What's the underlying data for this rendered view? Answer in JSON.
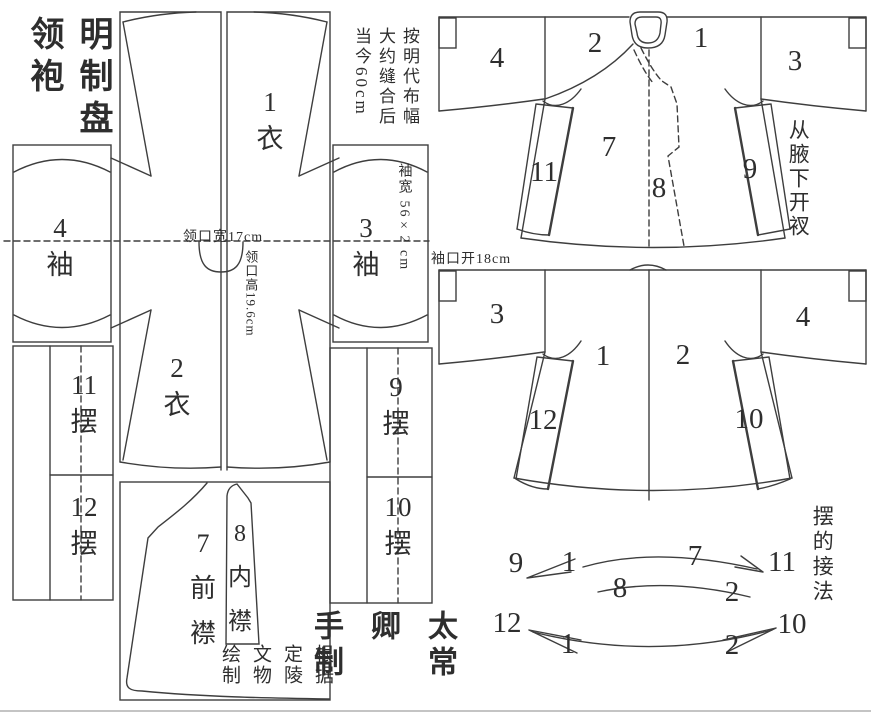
{
  "header": {
    "title": "明制盘\n领袍"
  },
  "notes": {
    "fabric": "按明代布幅\n大约缝合后\n当今60cm",
    "slit": "从腋下开衩",
    "assembly_title": "摆的接法",
    "credit": "根据\n定陵\n文物\n绘制",
    "signature": "太常卿\n手制"
  },
  "measurements": {
    "neck_width": "领口宽17cm",
    "neck_height": "领口高19.6cm",
    "sleeve_width": "袖宽 56×2 cm",
    "cuff_open": "袖口开18cm"
  },
  "pieces": {
    "p1": "1\n衣",
    "p2": "2\n衣",
    "p3": "3\n袖",
    "p4": "4\n袖",
    "p7": "7\n前\n襟",
    "p8": "8\n内\n襟",
    "p9": "9\n摆",
    "p10": "10\n摆",
    "p11": "11\n摆",
    "p12": "12\n摆"
  },
  "front_view": {
    "n1": "1",
    "n2": "2",
    "n3": "3",
    "n4": "4",
    "n7": "7",
    "n8": "8",
    "n9": "9",
    "n11": "11"
  },
  "back_view": {
    "n1": "1",
    "n2": "2",
    "n3": "3",
    "n4": "4",
    "n10": "10",
    "n12": "12"
  },
  "assembly": {
    "n9": "9",
    "n1a": "1",
    "n7": "7",
    "n11": "11",
    "n8": "8",
    "n2a": "2",
    "n12": "12",
    "n1b": "1",
    "n2b": "2",
    "n10": "10"
  },
  "colors": {
    "ink": "#3e3e3e",
    "background": "#ffffff"
  }
}
